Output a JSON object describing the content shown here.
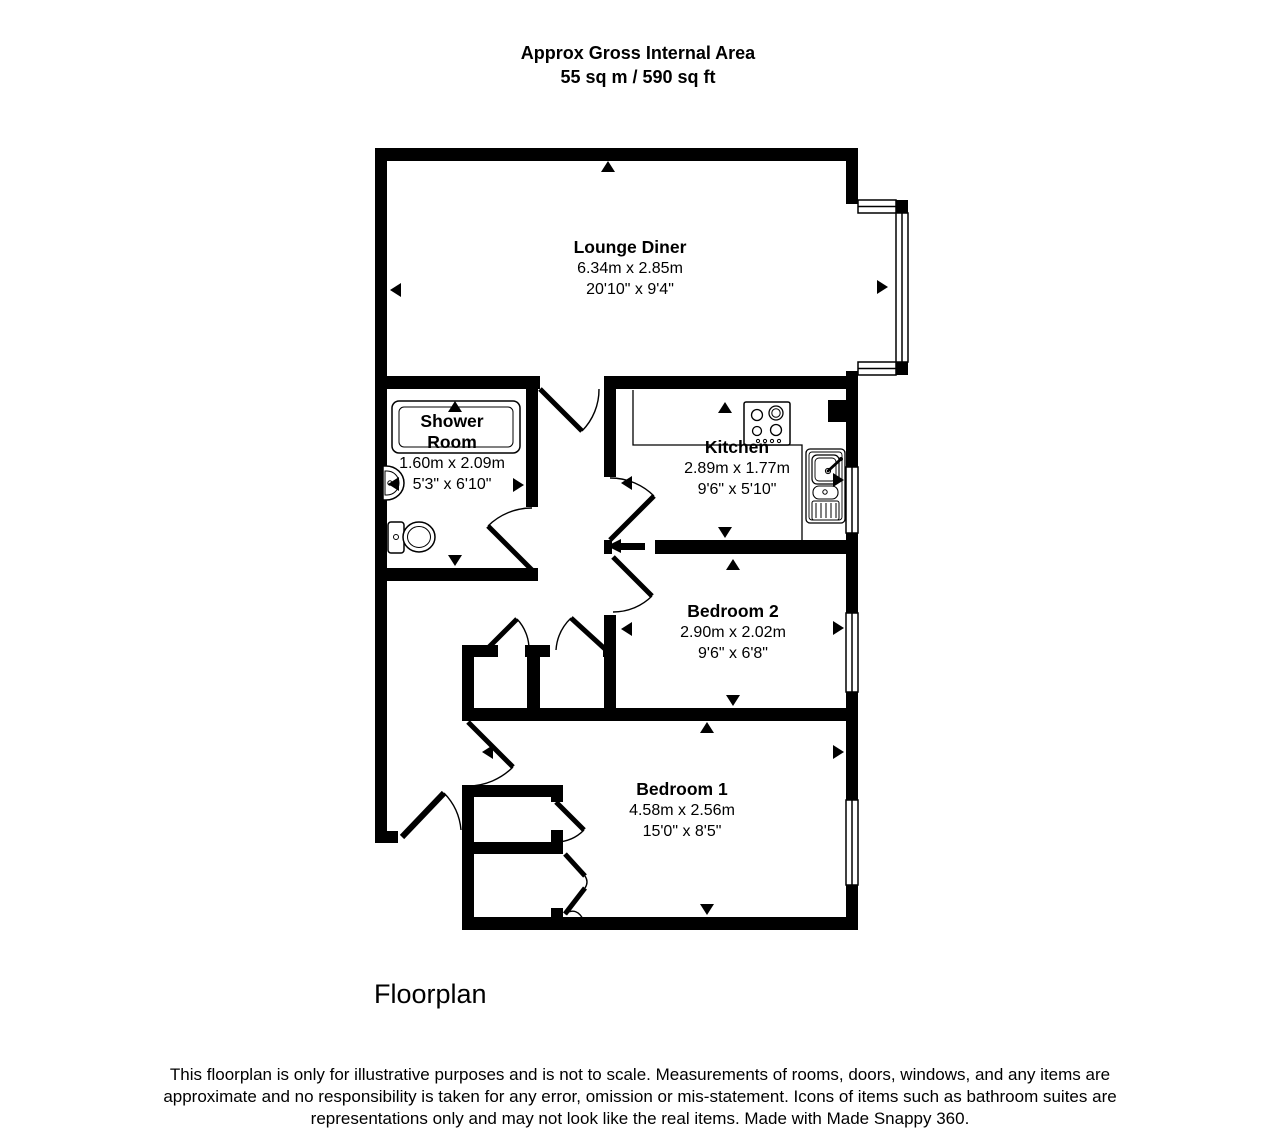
{
  "header": {
    "title_line1": "Approx Gross Internal Area",
    "title_line2": "55 sq m / 590 sq ft"
  },
  "rooms": {
    "lounge": {
      "name": "Lounge Diner",
      "metric": "6.34m x 2.85m",
      "imperial": "20'10\" x 9'4\""
    },
    "shower": {
      "name": "Shower Room",
      "metric": "1.60m x 2.09m",
      "imperial": "5'3\" x 6'10\""
    },
    "kitchen": {
      "name": "Kitchen",
      "metric": "2.89m x 1.77m",
      "imperial": "9'6\" x 5'10\""
    },
    "bedroom2": {
      "name": "Bedroom 2",
      "metric": "2.90m x 2.02m",
      "imperial": "9'6\" x 6'8\""
    },
    "bedroom1": {
      "name": "Bedroom 1",
      "metric": "4.58m x 2.56m",
      "imperial": "15'0\" x 8'5\""
    }
  },
  "icons": [
    "toilet-icon",
    "basin-icon",
    "shower-tray-icon",
    "hob-icon",
    "sink-icon",
    "window",
    "door-arc",
    "dimension-arrow"
  ],
  "footer": {
    "plan_label": "Floorplan",
    "disclaimer": "This floorplan is only for illustrative purposes and is not to scale. Measurements of rooms, doors, windows, and any items are approximate and no responsibility is taken for any error, omission or mis-statement. Icons of items such as bathroom suites are representations only and may not look like the real items. Made with Made Snappy 360."
  },
  "colors": {
    "wall": "#000000",
    "background": "#ffffff"
  }
}
